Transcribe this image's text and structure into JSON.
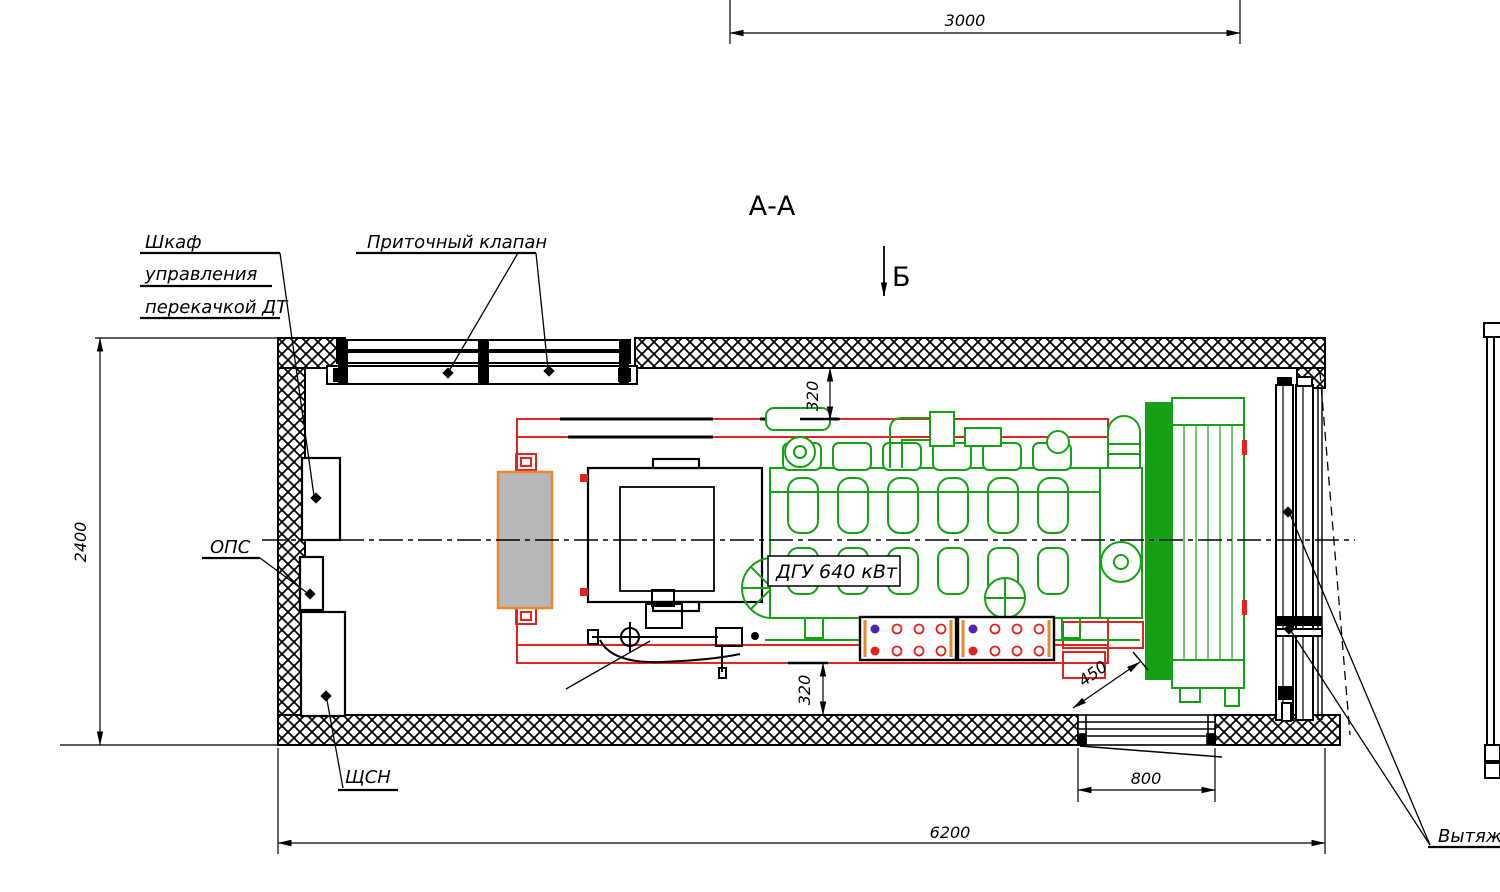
{
  "drawing": {
    "section_title": "А-А",
    "view_marker": "Б",
    "labels": {
      "fuel_cabinet_line1": "Шкаф",
      "fuel_cabinet_line2": "управления",
      "fuel_cabinet_line3": "перекачкой ДТ",
      "supply_valve": "Приточный клапан",
      "fire_alarm": "ОПС",
      "aux_switchboard": "ЩСН",
      "genset": "ДГУ 640 кВт",
      "exhaust_valve": "Вытяж."
    },
    "dimensions": {
      "top_width": "3000",
      "height": "2400",
      "gap_top": "320",
      "gap_bottom": "320",
      "radiator_gap": "450",
      "opening_width": "800",
      "total_length": "6200"
    },
    "colors": {
      "engine_green": "#14a214",
      "skid_red": "#e42320",
      "cabinet_orange": "#e8872b",
      "cabinet_gray": "#b8b8b8",
      "line_black": "#000000"
    }
  }
}
